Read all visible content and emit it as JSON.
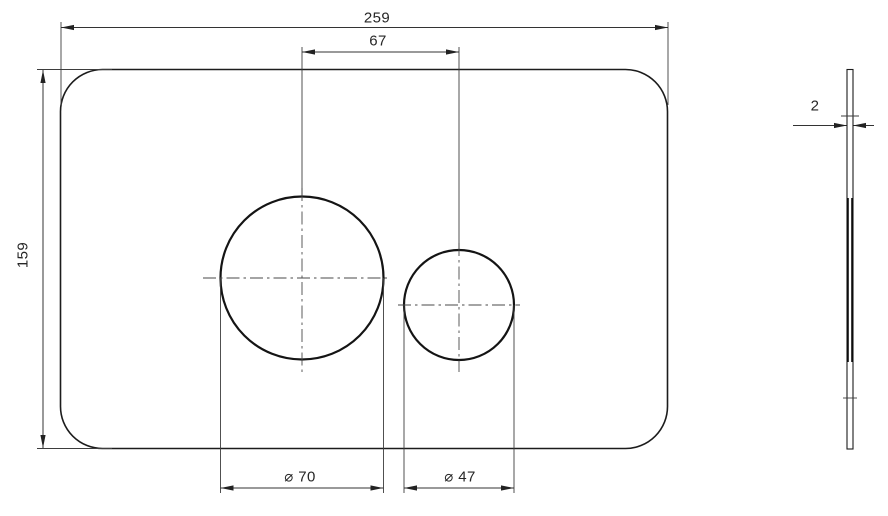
{
  "drawing": {
    "dimensions": {
      "overall_width": "259",
      "overall_height": "159",
      "button_center_distance": "67",
      "large_button_diameter": "⌀ 70",
      "small_button_diameter": "⌀ 47",
      "plate_thickness": "2"
    },
    "colors": {
      "outline": "#1c1c1c",
      "thin_line": "#3d3d3d",
      "text": "#262626",
      "background": "#ffffff"
    }
  }
}
